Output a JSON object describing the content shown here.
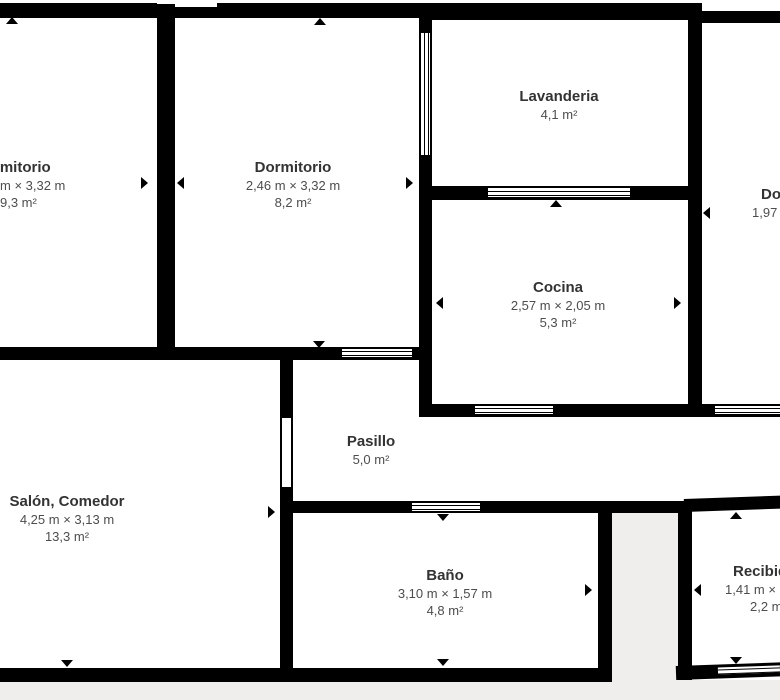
{
  "plan": {
    "type": "apartment-floor-plan",
    "language": "es",
    "colors": {
      "wall": "#000000",
      "room_fill": "#ffffff",
      "exterior": "#efeeec",
      "room_name_text": "#333333",
      "dimension_text": "#4d4d4d"
    },
    "rooms": {
      "dorm_left": {
        "name": "Dormitorio",
        "dims": "m × 3,32 m",
        "area": "9,3 m²"
      },
      "dorm_center": {
        "name": "Dormitorio",
        "dims": "2,46 m × 3,32 m",
        "area": "8,2 m²"
      },
      "lavanderia": {
        "name": "Lavanderia",
        "dims": "",
        "area": "4,1 m²"
      },
      "cocina": {
        "name": "Cocina",
        "dims": "2,57 m × 2,05 m",
        "area": "5,3 m²"
      },
      "dorm_right": {
        "name": "Dormitorio",
        "dims": "1,97",
        "area": ""
      },
      "salon": {
        "name": "Salón, Comedor",
        "dims": "4,25 m × 3,13 m",
        "area": "13,3 m²"
      },
      "pasillo": {
        "name": "Pasillo",
        "dims": "",
        "area": "5,0 m²"
      },
      "bano": {
        "name": "Baño",
        "dims": "3,10 m × 1,57 m",
        "area": "4,8 m²"
      },
      "recibidor": {
        "name": "Recibidor",
        "dims": "1,41 m × 1,",
        "area": "2,2 m²"
      }
    },
    "markers": {
      "door_direction_marker": "small solid black triangle",
      "window_symbol": "white slot with double parallel lines"
    }
  }
}
